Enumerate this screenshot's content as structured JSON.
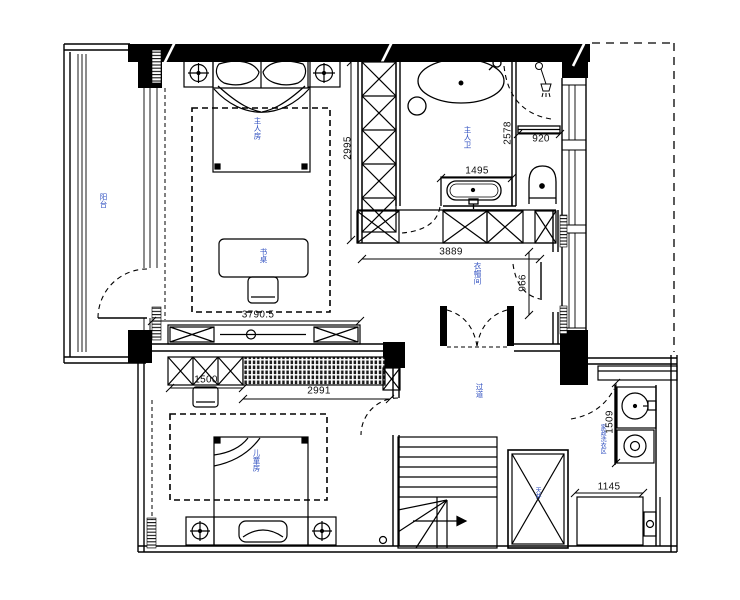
{
  "drawing": {
    "type": "residential-floor-plan",
    "rooms": {
      "balcony": "阳台",
      "master_bedroom": "主人房",
      "master_bath": "主人卫",
      "closet": "衣帽间",
      "hallway": "过道",
      "kids_room": "儿童房",
      "laundry": "家政洗衣区",
      "shaft": "天井",
      "desk": "书桌"
    },
    "dimensions": {
      "master_width": "3790.5",
      "wardrobe_depth": "2995",
      "bath_depth": "2578",
      "toilet_nook": "920",
      "vanity": "1495",
      "closet_width": "3889",
      "closet_door": "966",
      "cabinet_left": "1500",
      "cabinet_right": "2991",
      "laundry_depth": "1509",
      "laundry_counter": "1145"
    },
    "colors": {
      "line": "#000000",
      "dim": "#111111",
      "label": "#3050c0"
    }
  }
}
